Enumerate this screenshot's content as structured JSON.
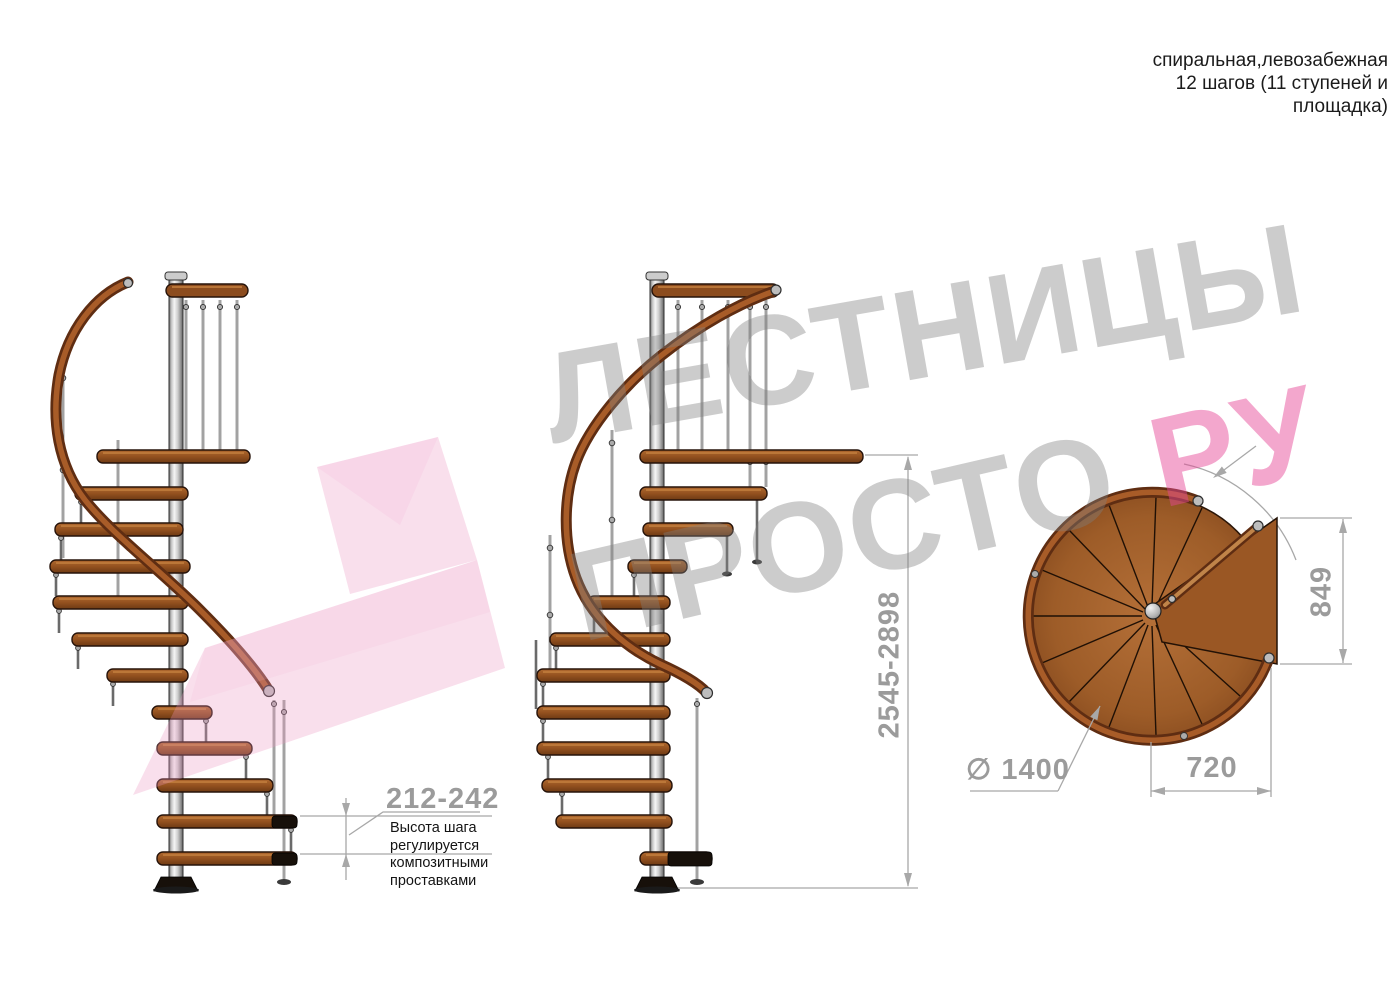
{
  "annotation_top_right": {
    "lines": [
      "спиральная,левозабежная",
      "12 шагов (11 ступеней и",
      "площадка)"
    ]
  },
  "dimensions": {
    "step_height": "212-242",
    "step_height_note": "Высота шага\nрегулируется\nкомпозитными\nпроставками",
    "total_height": "2545-2898",
    "landing_depth": "849",
    "landing_width": "720",
    "diameter_label": "∅ 1400"
  },
  "watermark": {
    "line1": "ЛЕСТНИЦЫ",
    "line2": "ПРОСТО",
    "line2_suffix": "РУ"
  },
  "colors": {
    "wood_step": "#9a5724",
    "wood_rail_dark": "#5f2d12",
    "wood_rail_light": "#a85c28",
    "metal_pole": "#c7c7c7",
    "dimension_gray": "#9b9b9b",
    "watermark_gray": "#cdcdcd",
    "watermark_pink": "#f2aacb",
    "text_black": "#1b1b1b"
  }
}
